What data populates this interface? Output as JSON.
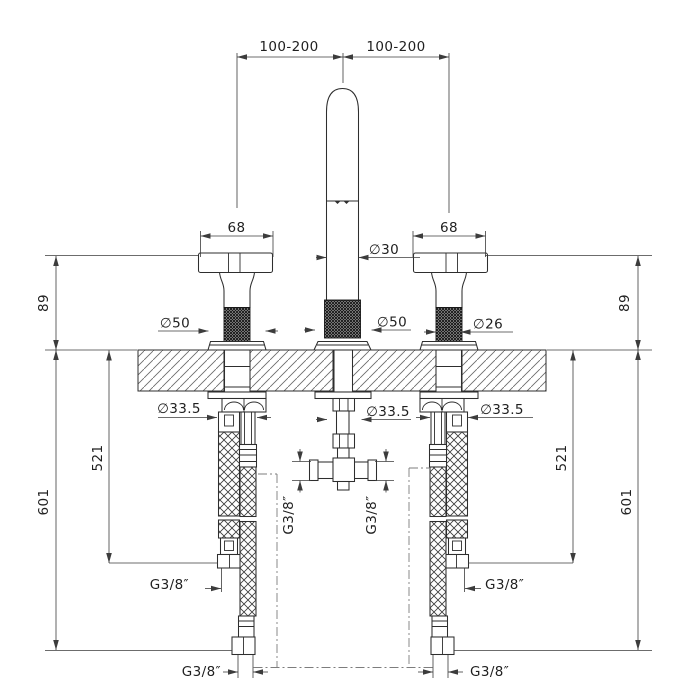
{
  "drawing": {
    "kind": "technical-dimension-drawing",
    "units_shown": "mm",
    "colors": {
      "background": "#ffffff",
      "outline": "#2e2e2e",
      "dimension_lines": "#3c3c3c",
      "text": "#1f1f1f",
      "hatch": "#6a6a6a",
      "phantom_line": "#7d7d7d"
    }
  },
  "labels": {
    "spacing_left": "100-200",
    "spacing_right": "100-200",
    "handle_width_left": "68",
    "handle_width_right": "68",
    "height_left": "89",
    "height_right": "89",
    "spout_diameter": "∅30",
    "handle_flange_diameter": "∅50",
    "spout_flange_diameter": "∅50",
    "handle_stem_diameter": "∅26",
    "shank_diameter_left": "∅33.5",
    "shank_diameter_center": "∅33.5",
    "shank_diameter_right": "∅33.5",
    "hose_drop_left": "521",
    "hose_drop_right": "521",
    "hose_length_left": "601",
    "hose_length_right": "601",
    "tee_port_left": "G3/8″",
    "tee_port_right": "G3/8″",
    "outlet_thread_left": "G3/8″",
    "outlet_thread_right": "G3/8″",
    "supply_thread_left": "G3/8″",
    "supply_thread_right": "G3/8″"
  }
}
